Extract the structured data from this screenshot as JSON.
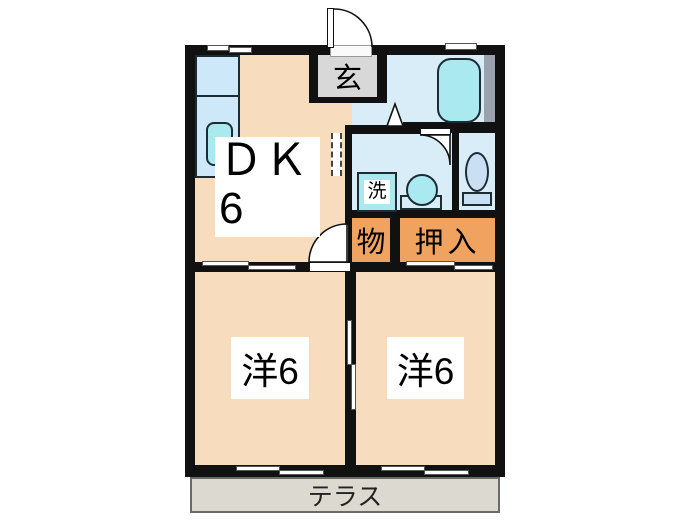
{
  "plan": {
    "type": "japanese-apartment-floor-plan",
    "rooms": {
      "dk": {
        "label_line1": "ＤＫ",
        "label_line2": "6"
      },
      "genkan": {
        "label": "玄"
      },
      "washroom": {
        "washer_label": "洗"
      },
      "storage": {
        "label": "物"
      },
      "oshiire": {
        "label": "押入"
      },
      "bedroom_left": {
        "label": "洋6"
      },
      "bedroom_right": {
        "label": "洋6"
      },
      "terrace": {
        "label": "テラス"
      }
    },
    "colors": {
      "floor_peach": "#f7ddbe",
      "closet_orange": "#f0a35e",
      "wet_blue": "#d9edf8",
      "fixture_cyan": "#aae9f0",
      "counter_blue": "#cde8f8",
      "toilet_blue": "#c9e0f4",
      "genkan_gray": "#d8d8d8",
      "pipe_gray": "#9aa2ae",
      "terrace_gray": "#dcd9d1",
      "wall_black": "#111111"
    }
  }
}
